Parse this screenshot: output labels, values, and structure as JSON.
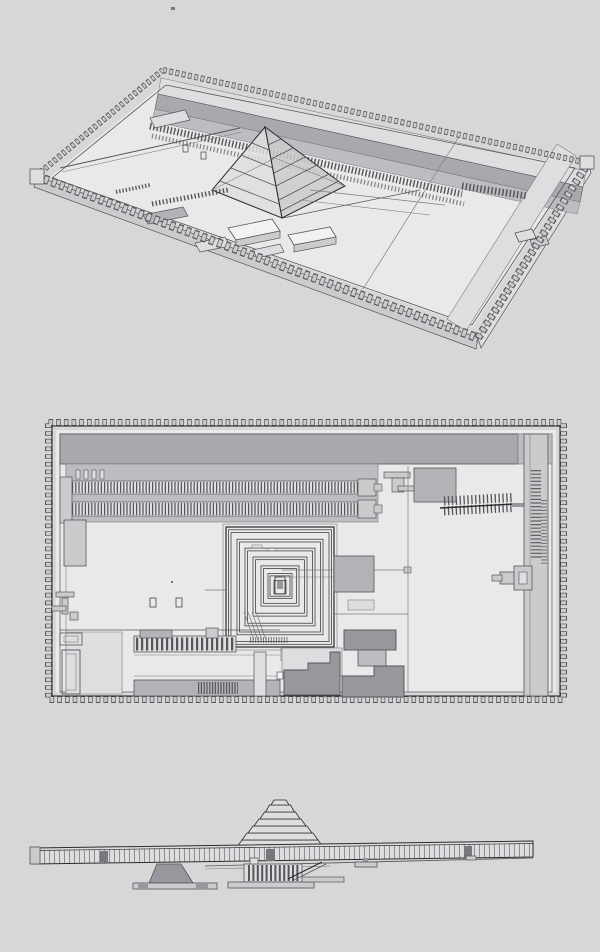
{
  "colors": {
    "bg": "#d7d7d7",
    "ink": "#2b2b2f",
    "ink2": "#55555a",
    "line": "#7d7d82",
    "white": "#f2f2f3",
    "floor": "#e9e9ea",
    "light": "#dedee0",
    "wall": "#cbcbce",
    "mid": "#bdbdc1",
    "band": "#a9a9ad",
    "gray": "#b3b3b7",
    "dark": "#97979d",
    "shadow": "#77777c"
  },
  "views": {
    "perspective": {
      "label": "aerial perspective view of walled step-pyramid complex"
    },
    "plan": {
      "label": "top-down plan view of walled step-pyramid complex"
    },
    "elevation": {
      "label": "side elevation view of step pyramid behind long paneled enclosure wall"
    }
  }
}
